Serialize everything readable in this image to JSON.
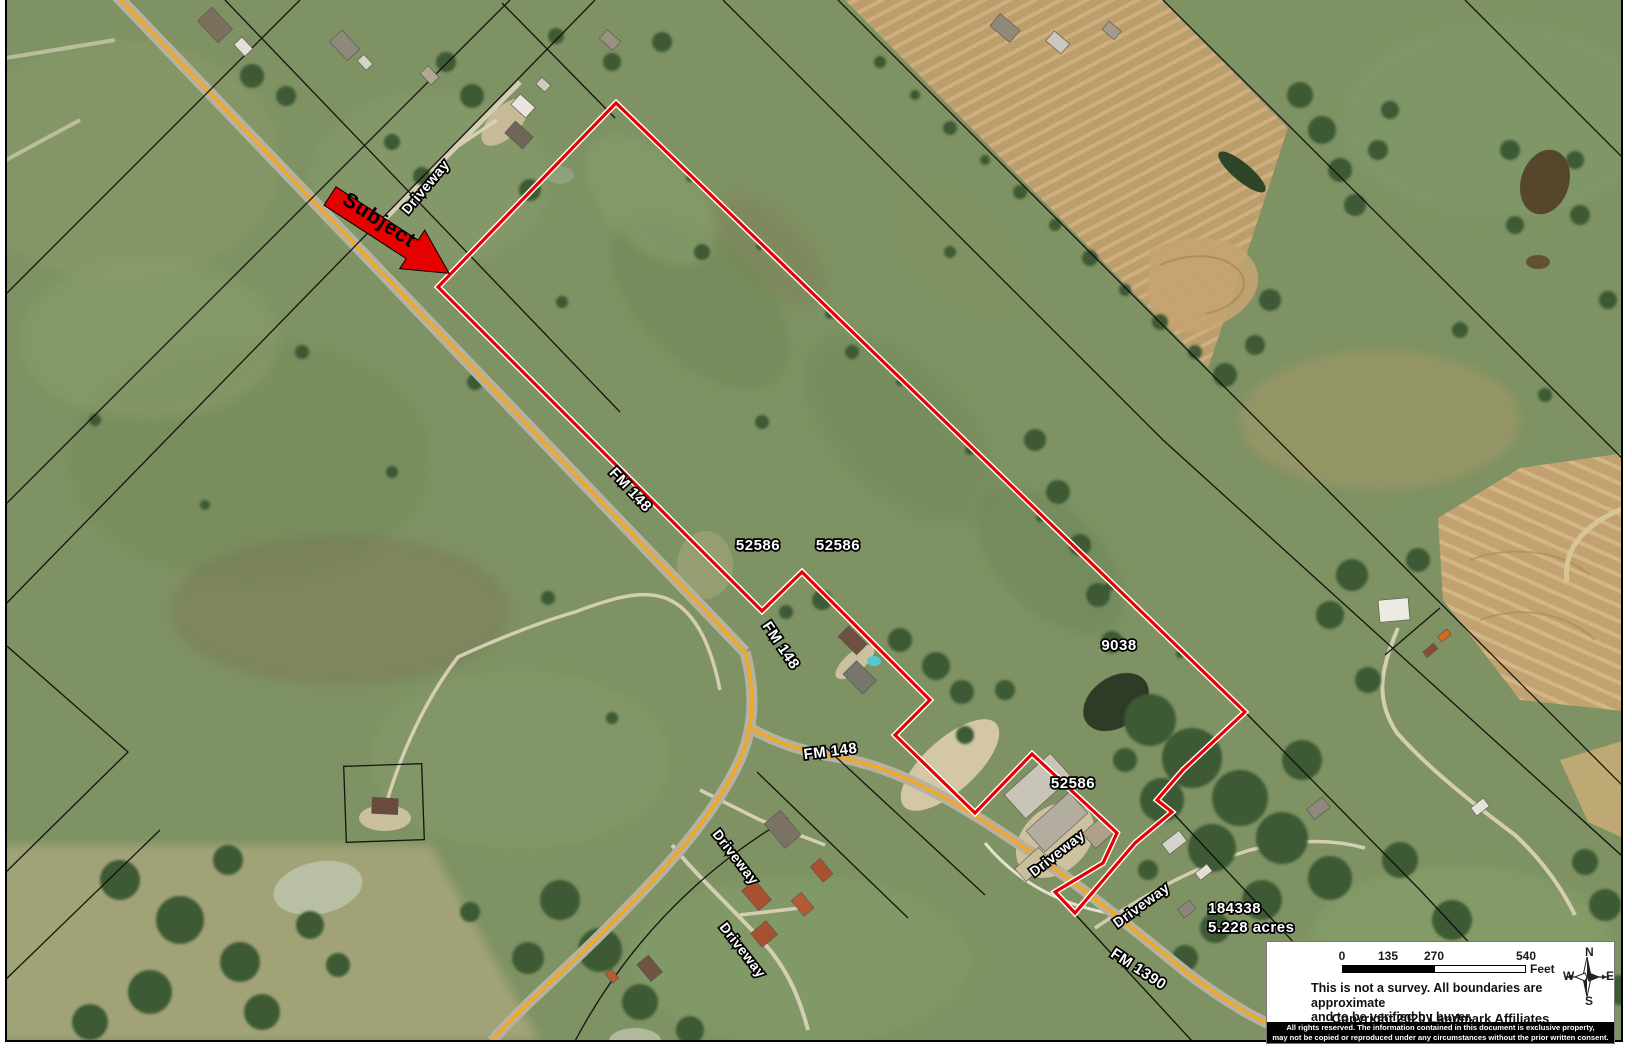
{
  "map": {
    "subject_label": "Subject",
    "labels": [
      {
        "text": "Driveway"
      },
      {
        "text": "FM 148"
      },
      {
        "text": "52586"
      },
      {
        "text": "52586"
      },
      {
        "text": "FM 148"
      },
      {
        "text": "FM 148"
      },
      {
        "text": "9038"
      },
      {
        "text": "52586"
      },
      {
        "text": "Driveway"
      },
      {
        "text": "Driveway"
      },
      {
        "text": "Driveway"
      },
      {
        "text": "Driveway"
      },
      {
        "text": "FM 1390"
      },
      {
        "text": "184338"
      },
      {
        "text": "5.228 acres"
      }
    ],
    "colors": {
      "boundary_red": "#e60000",
      "road_yellow": "#f3a81f",
      "parcel_line": "#0a0a0a"
    }
  },
  "legend": {
    "scale": {
      "ticks": [
        "0",
        "135",
        "270",
        "540"
      ],
      "unit": "Feet"
    },
    "compass": {
      "n": "N",
      "s": "S",
      "e": "E",
      "w": "W"
    },
    "disclaimer_line1": "This is not a survey.  All boundaries are approximate",
    "disclaimer_line2": "and to be verified by buyer.",
    "copyright": "Copyright 2020 Landmark Affiliates",
    "rights_line1": "All rights reserved. The information contained in this document is  exclusive property,",
    "rights_line2": "may not be copied or reproduced under any circumstances without the prior written consent."
  }
}
